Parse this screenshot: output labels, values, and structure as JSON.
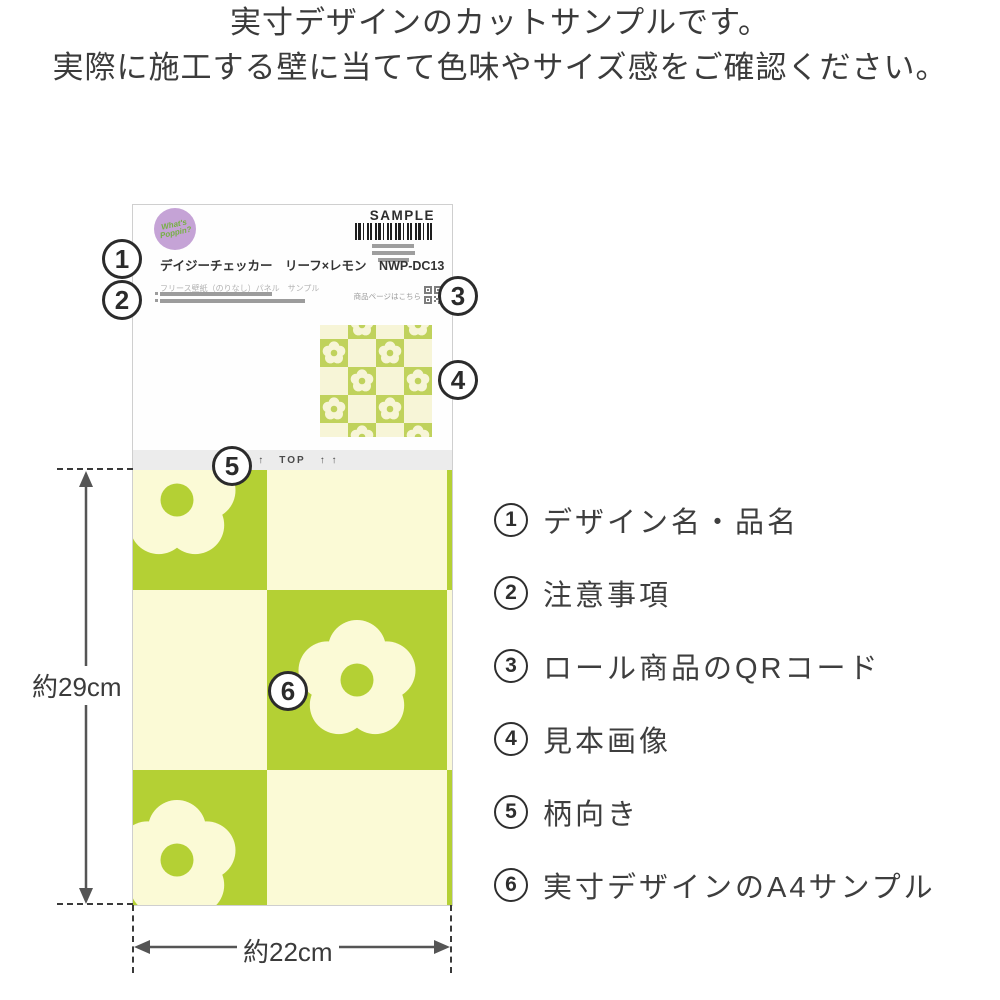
{
  "intro": {
    "line1": "実寸デザインのカットサンプルです。",
    "line2": "実際に施工する壁に当てて色味やサイズ感をご確認ください。"
  },
  "sample_card": {
    "brand_logo": {
      "line1": "What's",
      "line2": "Poppin?"
    },
    "sample_badge": "SAMPLE",
    "product_name": "デイジーチェッカー　リーフ×レモン　NWP-DC13",
    "product_spec": "フリース壁紙（のりなし）パネル　サンプル",
    "qr_caption": "商品ページはこちら",
    "orientation": {
      "arrows": "↑ ↑",
      "label": "TOP"
    }
  },
  "legend": {
    "items": [
      {
        "num": "1",
        "label": "デザイン名・品名"
      },
      {
        "num": "2",
        "label": "注意事項"
      },
      {
        "num": "3",
        "label": "ロール商品のQRコード"
      },
      {
        "num": "4",
        "label": "見本画像"
      },
      {
        "num": "5",
        "label": "柄向き"
      },
      {
        "num": "6",
        "label": "実寸デザインのA4サンプル"
      }
    ]
  },
  "dimensions": {
    "height": "約29cm",
    "width": "約22cm"
  },
  "colors": {
    "pattern_green": "#b4d034",
    "pattern_cream": "#fbfad6",
    "mini_green": "#c0d25c",
    "mini_cream": "#f7f5d7",
    "logo_purple": "#c5a3d6",
    "logo_text": "#76b043"
  }
}
